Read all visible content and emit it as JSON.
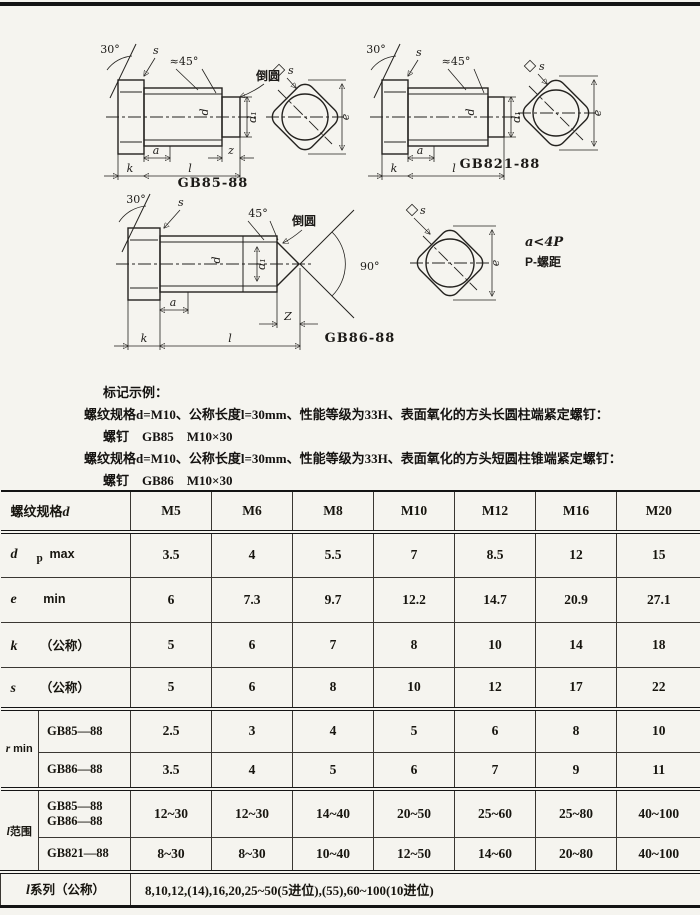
{
  "page": {
    "bg": "#f5f4ef",
    "ink": "#1f1d1a",
    "rule_color": "#141414"
  },
  "drawings": {
    "gb85": {
      "caption": "GB85-88",
      "a30": "30°",
      "a45": "≈45°",
      "fillet": "倒圆",
      "s": "s",
      "a": "a",
      "z": "z",
      "k": "k",
      "l": "l",
      "d": "d",
      "d1": "d₁",
      "e": "e"
    },
    "gb821": {
      "caption": "GB821-88",
      "a30": "30°",
      "a45": "≈45°",
      "s": "s",
      "a": "a",
      "k": "k",
      "l": "l",
      "d": "d",
      "d1": "d₁",
      "e": "e"
    },
    "gb86": {
      "caption": "GB86-88",
      "a30": "30°",
      "a45": "45°",
      "a90": "90°",
      "fillet": "倒圆",
      "s": "s",
      "a": "a",
      "z": "Z",
      "k": "k",
      "l": "l",
      "d": "d",
      "d1": "d₁",
      "e": "e"
    },
    "note": {
      "line1": "a<4P",
      "line2": "P-螺距"
    }
  },
  "marking": {
    "title": "标记示例：",
    "lines": [
      "螺纹规格d=M10、公称长度l=30mm、性能等级为33H、表面氧化的方头长圆柱端紧定螺钉：",
      "螺钉　GB85　M10×30",
      "螺纹规格d=M10、公称长度l=30mm、性能等级为33H、表面氧化的方头短圆柱锥端紧定螺钉：",
      "螺钉　GB86　M10×30"
    ]
  },
  "table": {
    "header": {
      "prefix": "螺纹规格",
      "sym": "d",
      "cols": [
        "M5",
        "M6",
        "M8",
        "M10",
        "M12",
        "M16",
        "M20"
      ]
    },
    "rows": [
      {
        "sym": "d",
        "sub": "p",
        "qual": "max",
        "values": [
          "3.5",
          "4",
          "5.5",
          "7",
          "8.5",
          "12",
          "15"
        ]
      },
      {
        "sym": "e",
        "sub": "",
        "qual": "min",
        "values": [
          "6",
          "7.3",
          "9.7",
          "12.2",
          "14.7",
          "20.9",
          "27.1"
        ]
      },
      {
        "sym": "k",
        "sub": "",
        "qual": "（公称）",
        "values": [
          "5",
          "6",
          "7",
          "8",
          "10",
          "14",
          "18"
        ]
      },
      {
        "sym": "s",
        "sub": "",
        "qual": "（公称）",
        "values": [
          "5",
          "6",
          "8",
          "10",
          "12",
          "17",
          "22"
        ]
      }
    ],
    "group_r": {
      "sym": "r",
      "qual": "min",
      "rows": [
        {
          "sub_label": "GB85—88",
          "values": [
            "2.5",
            "3",
            "4",
            "5",
            "6",
            "8",
            "10"
          ]
        },
        {
          "sub_label": "GB86—88",
          "values": [
            "3.5",
            "4",
            "5",
            "6",
            "7",
            "9",
            "11"
          ]
        }
      ]
    },
    "group_l": {
      "sym": "l",
      "qual": "范围",
      "rows": [
        {
          "sub_label": "GB85—88",
          "sub_label2": "GB86—88",
          "values": [
            "12~30",
            "12~30",
            "14~40",
            "20~50",
            "25~60",
            "25~80",
            "40~100"
          ]
        },
        {
          "sub_label": "GB821—88",
          "sub_label2": "",
          "values": [
            "8~30",
            "8~30",
            "10~40",
            "12~50",
            "14~60",
            "20~80",
            "40~100"
          ]
        }
      ]
    },
    "series": {
      "sym": "l",
      "qual": "系列（公称）",
      "value": "8,10,12,(14),16,20,25~50(5进位),(55),60~100(10进位)"
    }
  }
}
